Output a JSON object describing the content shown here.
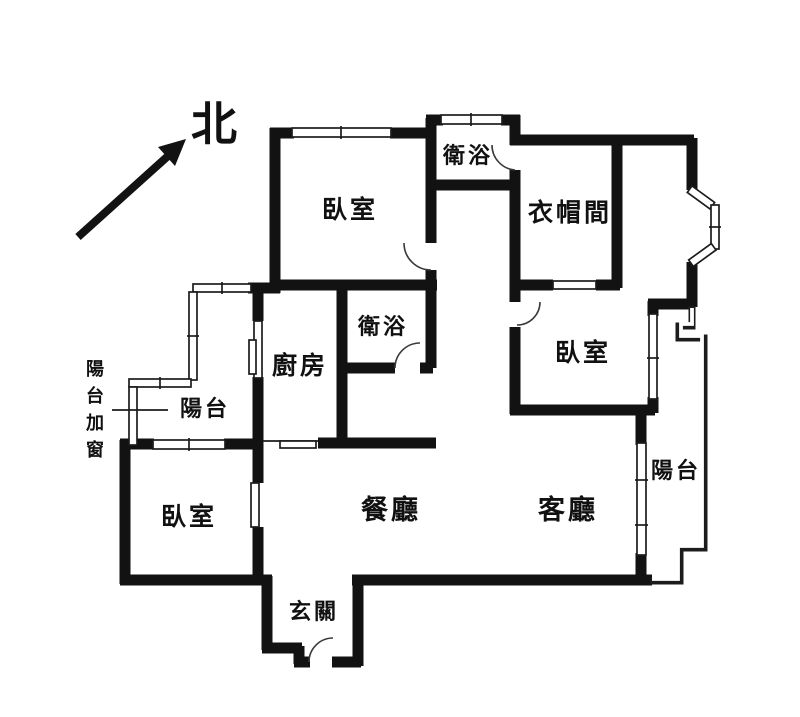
{
  "floorplan": {
    "title": "apartment-floor-plan",
    "compass": {
      "label": "北"
    },
    "annotation": {
      "label": "陽台加窗",
      "chars": {
        "c0": "陽",
        "c1": "台",
        "c2": "加",
        "c3": "窗"
      }
    },
    "rooms": {
      "bedroom_top": {
        "label": "臥室"
      },
      "bath_top": {
        "label": "衛浴"
      },
      "closet": {
        "label": "衣帽間"
      },
      "bedroom_right": {
        "label": "臥室"
      },
      "bath_mid": {
        "label": "衛浴"
      },
      "kitchen": {
        "label": "廚房"
      },
      "balcony_left": {
        "label": "陽台"
      },
      "bedroom_left": {
        "label": "臥室"
      },
      "dining": {
        "label": "餐廳"
      },
      "living": {
        "label": "客廳"
      },
      "balcony_right": {
        "label": "陽台"
      },
      "entry": {
        "label": "玄關"
      }
    },
    "colors": {
      "wall": "#121212",
      "background": "#ffffff",
      "window_line": "#1c1c1c"
    }
  }
}
